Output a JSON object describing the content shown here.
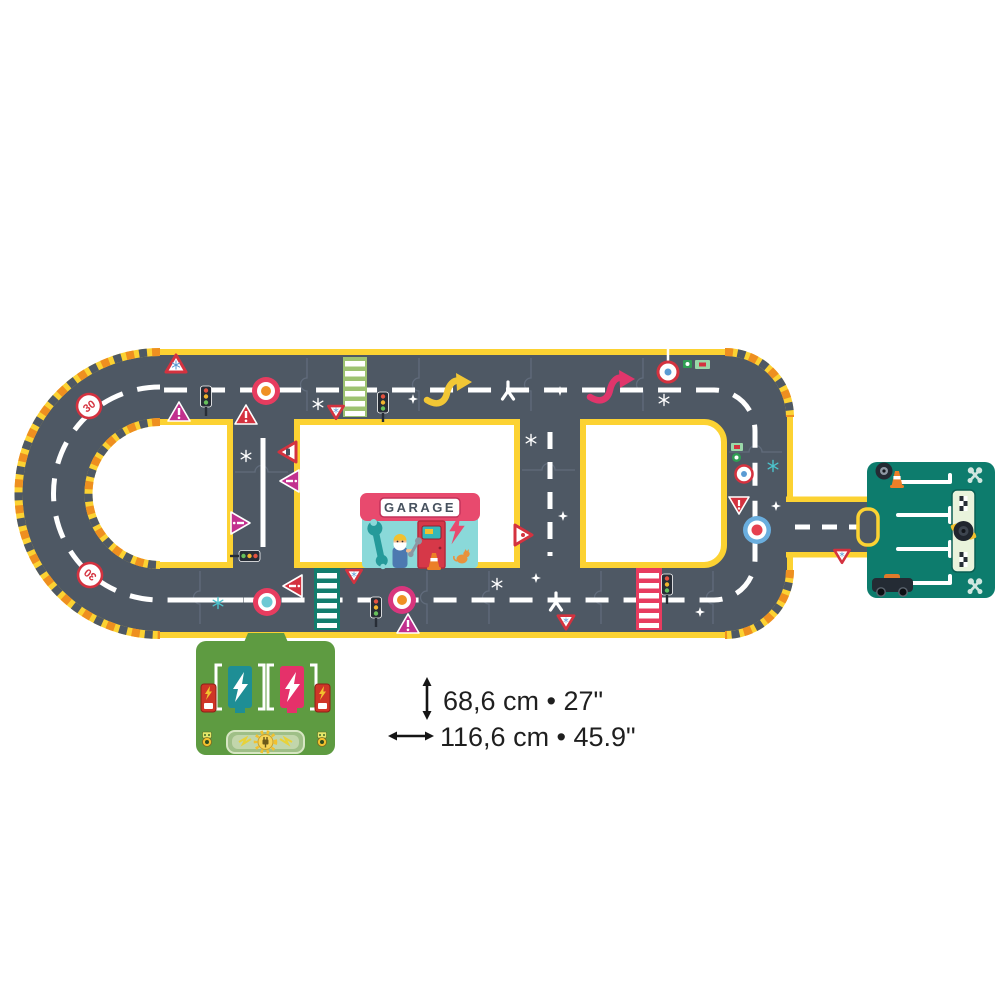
{
  "page": {
    "background": "#ffffff",
    "type": "product-photo-road-puzzle"
  },
  "product": {
    "garage": {
      "sign_text": "GARAGE"
    },
    "signs": {
      "speed_limit": "30"
    },
    "dimensions": {
      "height_label": "68,6 cm • 27\"",
      "width_label": "116,6 cm • 45.9\""
    }
  },
  "colors": {
    "road": "#4e5864",
    "edge_yellow": "#fcd232",
    "hazard_orange": "#ee8f20",
    "marking_white": "#ffffff",
    "crosswalk_green": "#9dc271",
    "crosswalk_teal": "#137d6d",
    "crosswalk_pink": "#e73c5f",
    "roundabout_red": "#e73c5f",
    "roundabout_orange": "#ef9025",
    "roundabout_teal": "#6ec9d4",
    "roundabout_magenta": "#d8367d",
    "roundabout_blue": "#6aaede",
    "sign_red": "#d4323f",
    "sign_magenta": "#c2308e",
    "parking_teal": "#0d7c6d",
    "charging_green": "#5e9b41",
    "garage_pink": "#e84a6e",
    "garage_teal": "#8ad9d9",
    "annotation_text": "#1f1f1f"
  },
  "icons": {
    "dimension-arrow-vertical": "↕",
    "dimension-arrow-horizontal": "↔",
    "snowflake-icon": "✳",
    "star-icon": "✦",
    "warning-sign-icon": "△",
    "yield-sign-icon": "▽",
    "speed-limit-30-sign": "(30)",
    "roundabout-icon": "◎",
    "traffic-light-icon": "traffic-light",
    "crosswalk-icon": "striped-band",
    "curved-arrow-icon": "s-arrow",
    "merge-arrow-icon": "y-arrow",
    "wrench-icon": "wrench",
    "lightning-bolt-icon": "⚡",
    "checkered-flag-icon": "checker",
    "traffic-cone-icon": "cone",
    "tire-icon": "tire",
    "car-icon": "car",
    "charging-post-icon": "charger",
    "medal-icon": "medal",
    "plug-sun-icon": "plug"
  }
}
